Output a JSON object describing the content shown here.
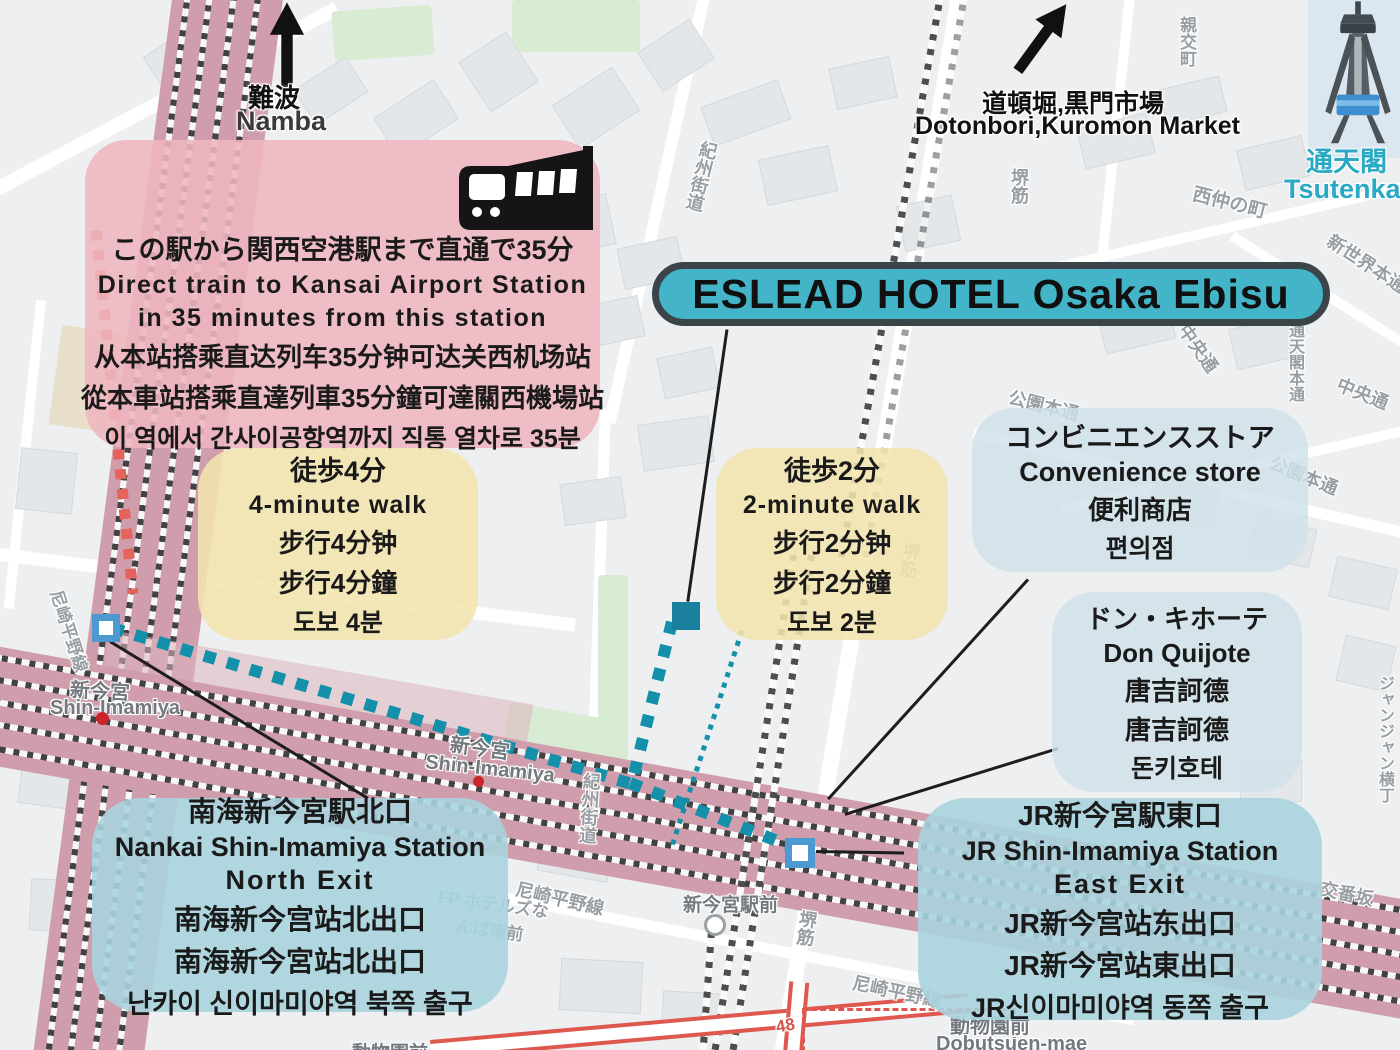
{
  "title": {
    "text": "ESLEAD HOTEL Osaka Ebisu"
  },
  "directions": {
    "namba_ja": "難波",
    "namba_en": "Namba",
    "dotonbori_ja": "道頓堀,黒門市場",
    "dotonbori_en": "Dotonbori,Kuromon Market",
    "tsutenkaku_ja": "通天閣",
    "tsutenkaku_en": "Tsutenkaku"
  },
  "airport_note": {
    "lines": [
      "この駅から関西空港駅まで直通で35分",
      "Direct train to Kansai Airport Station",
      "in 35 minutes from this station",
      "从本站搭乘直达列车35分钟可达关西机场站",
      "從本車站搭乘直達列車35分鐘可達關西機場站",
      "이 역에서 간사이공항역까지 직통 열차로 35분"
    ]
  },
  "walk4": {
    "lines": [
      "徒歩4分",
      "4-minute walk",
      "步行4分钟",
      "步行4分鐘",
      "도보 4분"
    ]
  },
  "walk2": {
    "lines": [
      "徒歩2分",
      "2-minute walk",
      "步行2分钟",
      "步行2分鐘",
      "도보 2분"
    ]
  },
  "convenience": {
    "lines": [
      "コンビニエンスストア",
      "Convenience store",
      "便利商店",
      "편의점"
    ]
  },
  "donki": {
    "lines": [
      "ドン・キホーテ",
      "Don Quijote",
      "唐吉訶德",
      "唐吉訶德",
      "돈키호테"
    ]
  },
  "nankai": {
    "lines": [
      "南海新今宮駅北口",
      "Nankai Shin-Imamiya Station",
      "North Exit",
      "南海新今宫站北出口",
      "南海新今宮站北出口",
      "난카이 신이마미야역 북쪽 출구"
    ]
  },
  "jr": {
    "lines": [
      "JR新今宮駅東口",
      "JR Shin-Imamiya Station",
      "East Exit",
      "JR新今宫站东出口",
      "JR新今宮站東出口",
      "JR신이마미야역 동쪽 출구"
    ]
  },
  "map_labels": {
    "shin_imamiya_ja": "新今宮",
    "shin_imamiya_en": "Shin-Imamiya",
    "station_front": "新今宮駅前",
    "dobutsuen_ja": "動物園前",
    "dobutsuen_en": "Dobutsuen-mae",
    "kishu_kaido": "紀州街道",
    "amagasaki_hirano_line": "尼崎平野線",
    "sakai_suji": "堺筋",
    "nishinaka_cho": "西仲の町",
    "shinsekai_hondori": "新世界本通",
    "chuo_dori": "中央通",
    "koen_hondori": "公園本通",
    "shinko_cho": "親交町",
    "koban_zaka": "交番坂",
    "janjan_yokocho": "ジャンジャン横丁",
    "tsutenkaku_hondori": "通天閣本通",
    "fp_hotels_line1": "FP ホテルズな",
    "fp_hotels_line2": "んば南前",
    "route_48": "48"
  },
  "colors": {
    "title_bg": "#44b5c9",
    "title_border": "#3b4549",
    "airport_box": "#efb6bf",
    "walk_box": "#f3e5ae",
    "info_box": "#cfe2e9",
    "station_box": "#a9d4de",
    "route_dot": "#1590aa",
    "airport_route_dot": "#e4635c",
    "exit_marker_border": "#4d9ad3",
    "hotel_marker": "#1b7f9e",
    "tsutenkaku_text": "#29a9c4",
    "rail_band": "#cf9dab"
  }
}
